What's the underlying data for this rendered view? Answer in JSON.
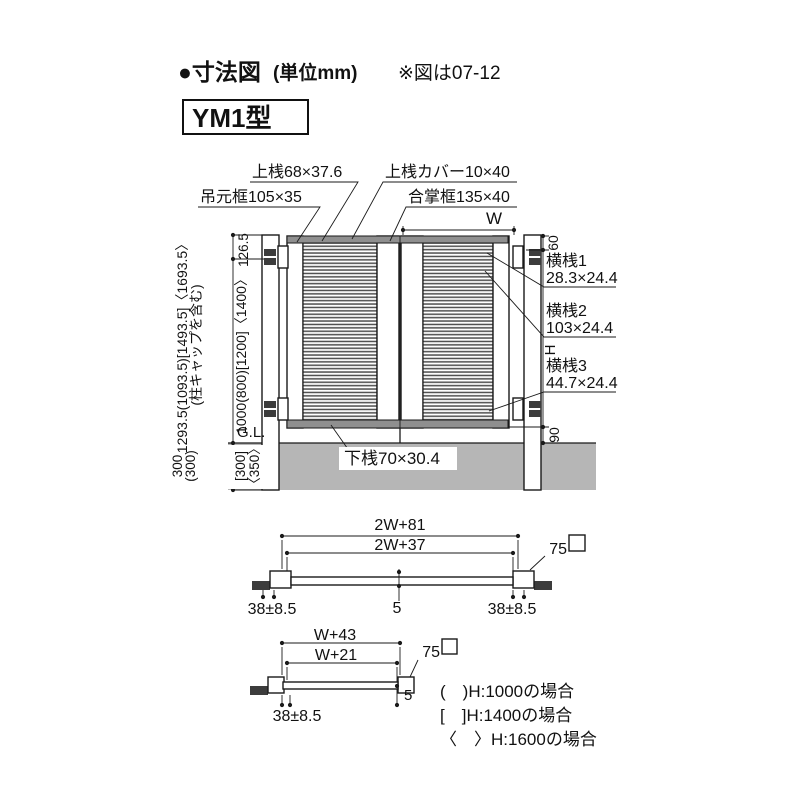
{
  "header": {
    "title_main": "●寸法図",
    "title_unit": "(単位mm)",
    "note": "※図は07-12",
    "model": "YM1型"
  },
  "front_view": {
    "labels": {
      "top_rail": "上桟68×37.6",
      "hinge_stile": "吊元框105×35",
      "top_rail_cover": "上桟カバー10×40",
      "meeting_stile": "合掌框135×40",
      "bottom_rail": "下桟70×30.4",
      "ground_line": "G.L."
    },
    "crossbars": [
      {
        "name": "横桟1",
        "size": "28.3×24.4"
      },
      {
        "name": "横桟2",
        "size": "103×24.4"
      },
      {
        "name": "横桟3",
        "size": "44.7×24.4"
      }
    ],
    "dimensions": {
      "width": "W",
      "top_offset": "126.5",
      "total_height": "1293.5(1093.5)[1493.5]〈1693.5〉",
      "total_height_note": "(柱キャップを含む)",
      "door_height": "1000(800)[1200]〈1400〉",
      "top_gap": "60",
      "height": "H",
      "bottom_gap": "90",
      "embed_front": "300",
      "embed_front_alt": "(300)",
      "embed_back": "[300]",
      "embed_back_alt": "〈350〉"
    }
  },
  "plan_double": {
    "overall": "2W+81",
    "inner": "2W+37",
    "hinge_offset_left": "38±8.5",
    "center_gap": "5",
    "hinge_offset_right": "38±8.5",
    "post_size": "75"
  },
  "plan_single": {
    "overall": "W+43",
    "inner": "W+21",
    "hinge_offset": "38±8.5",
    "end_gap": "5",
    "post_size": "75"
  },
  "legend": [
    "(　)H:1000の場合",
    "[　]H:1400の場合",
    "〈　〉H:1600の場合"
  ],
  "colors": {
    "ground": "#b6b6b6",
    "rail": "#8f8f8f",
    "line": "#1a1a1a"
  }
}
